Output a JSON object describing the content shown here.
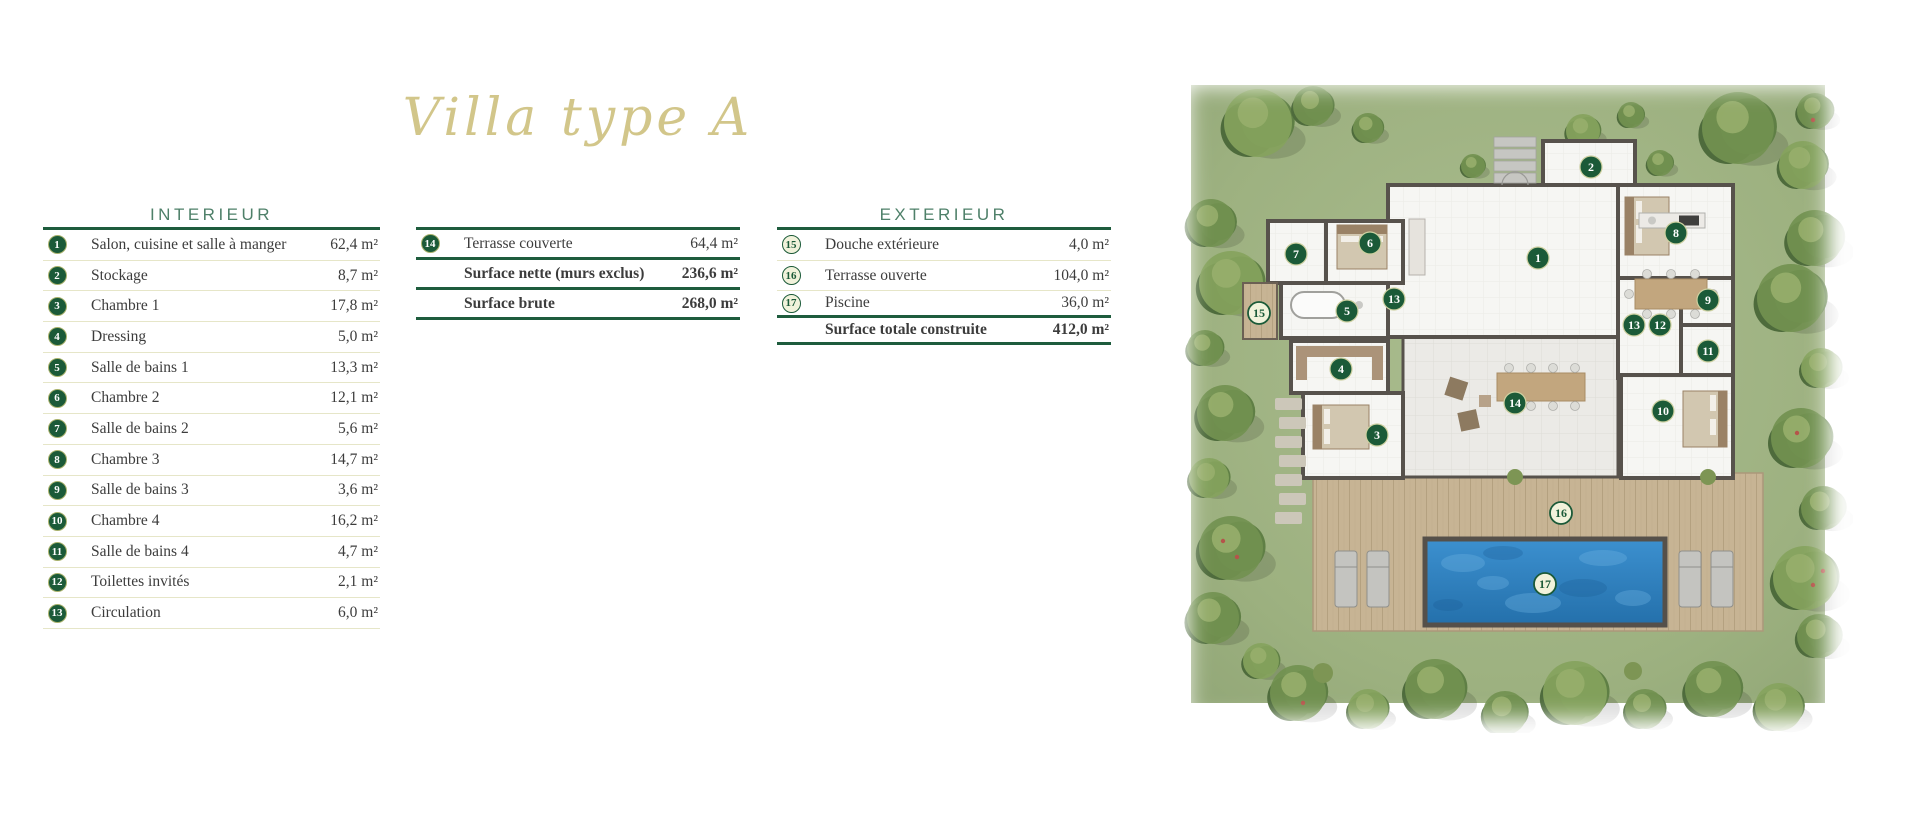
{
  "page": {
    "title": "Villa type A"
  },
  "theme": {
    "badge_dark": "#1b5a38",
    "header_green": "#4e8069",
    "gold": "#d2c68a",
    "rule_green": "#1e5c3d",
    "sep_cream": "#e6e6c8",
    "text_dark": "#3c3c3c",
    "badge_light_bg": "#f1f2db",
    "grass_green": "#9db180",
    "deck_tan": "#c7b494",
    "pool_blue": "#2e7fc2",
    "wall_gray": "#57524c"
  },
  "interior": {
    "header": "INTERIEUR",
    "rows": [
      {
        "n": "1",
        "label": "Salon, cuisine et salle à manger",
        "value": "62,4 m²"
      },
      {
        "n": "2",
        "label": "Stockage",
        "value": "8,7 m²"
      },
      {
        "n": "3",
        "label": "Chambre 1",
        "value": "17,8 m²"
      },
      {
        "n": "4",
        "label": "Dressing",
        "value": "5,0 m²"
      },
      {
        "n": "5",
        "label": "Salle de bains 1",
        "value": "13,3 m²"
      },
      {
        "n": "6",
        "label": "Chambre 2",
        "value": "12,1 m²"
      },
      {
        "n": "7",
        "label": "Salle de bains 2",
        "value": "5,6 m²"
      },
      {
        "n": "8",
        "label": "Chambre 3",
        "value": "14,7 m²"
      },
      {
        "n": "9",
        "label": "Salle de bains 3",
        "value": "3,6 m²"
      },
      {
        "n": "10",
        "label": "Chambre 4",
        "value": "16,2 m²"
      },
      {
        "n": "11",
        "label": "Salle de bains 4",
        "value": "4,7 m²"
      },
      {
        "n": "12",
        "label": "Toilettes invités",
        "value": "2,1 m²"
      },
      {
        "n": "13",
        "label": "Circulation",
        "value": "6,0 m²"
      }
    ]
  },
  "surfaces": {
    "rows": [
      {
        "n": "14",
        "label": "Terrasse couverte",
        "value": "64,4 m²"
      },
      {
        "label": "Surface nette (murs exclus)",
        "value": "236,6 m²",
        "style": "bold"
      },
      {
        "label": "Surface brute",
        "value": "268,0 m²",
        "style": "bold"
      }
    ]
  },
  "exterior": {
    "header": "EXTERIEUR",
    "rows": [
      {
        "n": "15",
        "label": "Douche extérieure",
        "value": "4,0 m²",
        "style": "light"
      },
      {
        "n": "16",
        "label": "Terrasse ouverte",
        "value": "104,0 m²",
        "style": "light"
      },
      {
        "n": "17",
        "label": "Piscine",
        "value": "36,0 m²",
        "style": "light dark-sep r17"
      },
      {
        "label": "Surface totale construite",
        "value": "412,0 m²",
        "style": "bold dark-sep total"
      }
    ]
  },
  "plan": {
    "markers": [
      {
        "n": "1",
        "x": 375,
        "y": 185,
        "style": "dark"
      },
      {
        "n": "2",
        "x": 428,
        "y": 94,
        "style": "dark"
      },
      {
        "n": "3",
        "x": 214,
        "y": 362,
        "style": "dark"
      },
      {
        "n": "4",
        "x": 178,
        "y": 296,
        "style": "dark"
      },
      {
        "n": "5",
        "x": 184,
        "y": 238,
        "style": "dark"
      },
      {
        "n": "6",
        "x": 207,
        "y": 170,
        "style": "dark"
      },
      {
        "n": "7",
        "x": 133,
        "y": 181,
        "style": "dark"
      },
      {
        "n": "8",
        "x": 513,
        "y": 160,
        "style": "dark"
      },
      {
        "n": "9",
        "x": 545,
        "y": 227,
        "style": "dark"
      },
      {
        "n": "10",
        "x": 500,
        "y": 338,
        "style": "dark"
      },
      {
        "n": "11",
        "x": 545,
        "y": 278,
        "style": "dark"
      },
      {
        "n": "12",
        "x": 497,
        "y": 252,
        "style": "dark"
      },
      {
        "n": "13",
        "x": 231,
        "y": 226,
        "style": "dark"
      },
      {
        "n": "13",
        "x": 471,
        "y": 252,
        "style": "dark"
      },
      {
        "n": "14",
        "x": 352,
        "y": 330,
        "style": "dark"
      },
      {
        "n": "15",
        "x": 96,
        "y": 240,
        "style": "light"
      },
      {
        "n": "16",
        "x": 398,
        "y": 440,
        "style": "light"
      },
      {
        "n": "17",
        "x": 382,
        "y": 511,
        "style": "light"
      }
    ]
  }
}
